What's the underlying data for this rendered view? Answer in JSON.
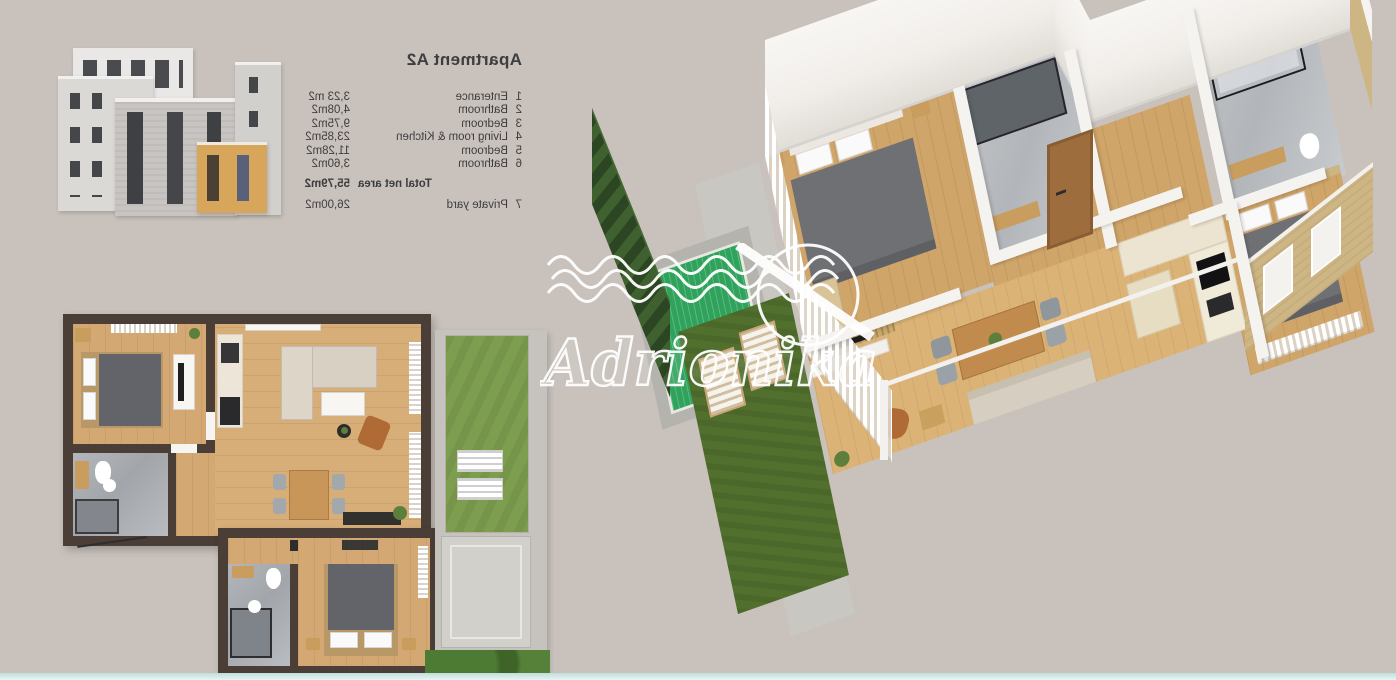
{
  "legend": {
    "title": "Apartment A2",
    "mirrored_text": true,
    "rows": [
      {
        "num": "1",
        "label": "Enterance",
        "area": "3,23 m2"
      },
      {
        "num": "2",
        "label": "Bathroom",
        "area": "4,08m2"
      },
      {
        "num": "3",
        "label": "Bedroom",
        "area": "9,75m2"
      },
      {
        "num": "4",
        "label": "Living room & Kitchen",
        "area": "23,85m2"
      },
      {
        "num": "5",
        "label": "Bedroom",
        "area": "11,28m2"
      },
      {
        "num": "6",
        "label": "Bathroom",
        "area": "3,60m2"
      }
    ],
    "total": {
      "label": "Total net area",
      "area": "55,79m2"
    },
    "extra": {
      "num": "7",
      "label": "Private yard",
      "area": "26,00m2"
    }
  },
  "watermark": {
    "text": "Adrionika",
    "color": "#ffffff"
  },
  "colors": {
    "background": "#c9c2bc",
    "plan_wall": "#4a3e36",
    "wood_floor": "#d3a873",
    "lawn_2d": "#7d9e4f",
    "pool_2d": "#3eb29b",
    "lawn_3d": "#51702e",
    "pool_3d": "#2fa35c",
    "hedge": "#35522a",
    "stone_wall": "#a7a49e",
    "tan_wall": "#cdb584",
    "highlight_unit": "#d7a65a",
    "bottom_strip": "#bfe0dd"
  }
}
